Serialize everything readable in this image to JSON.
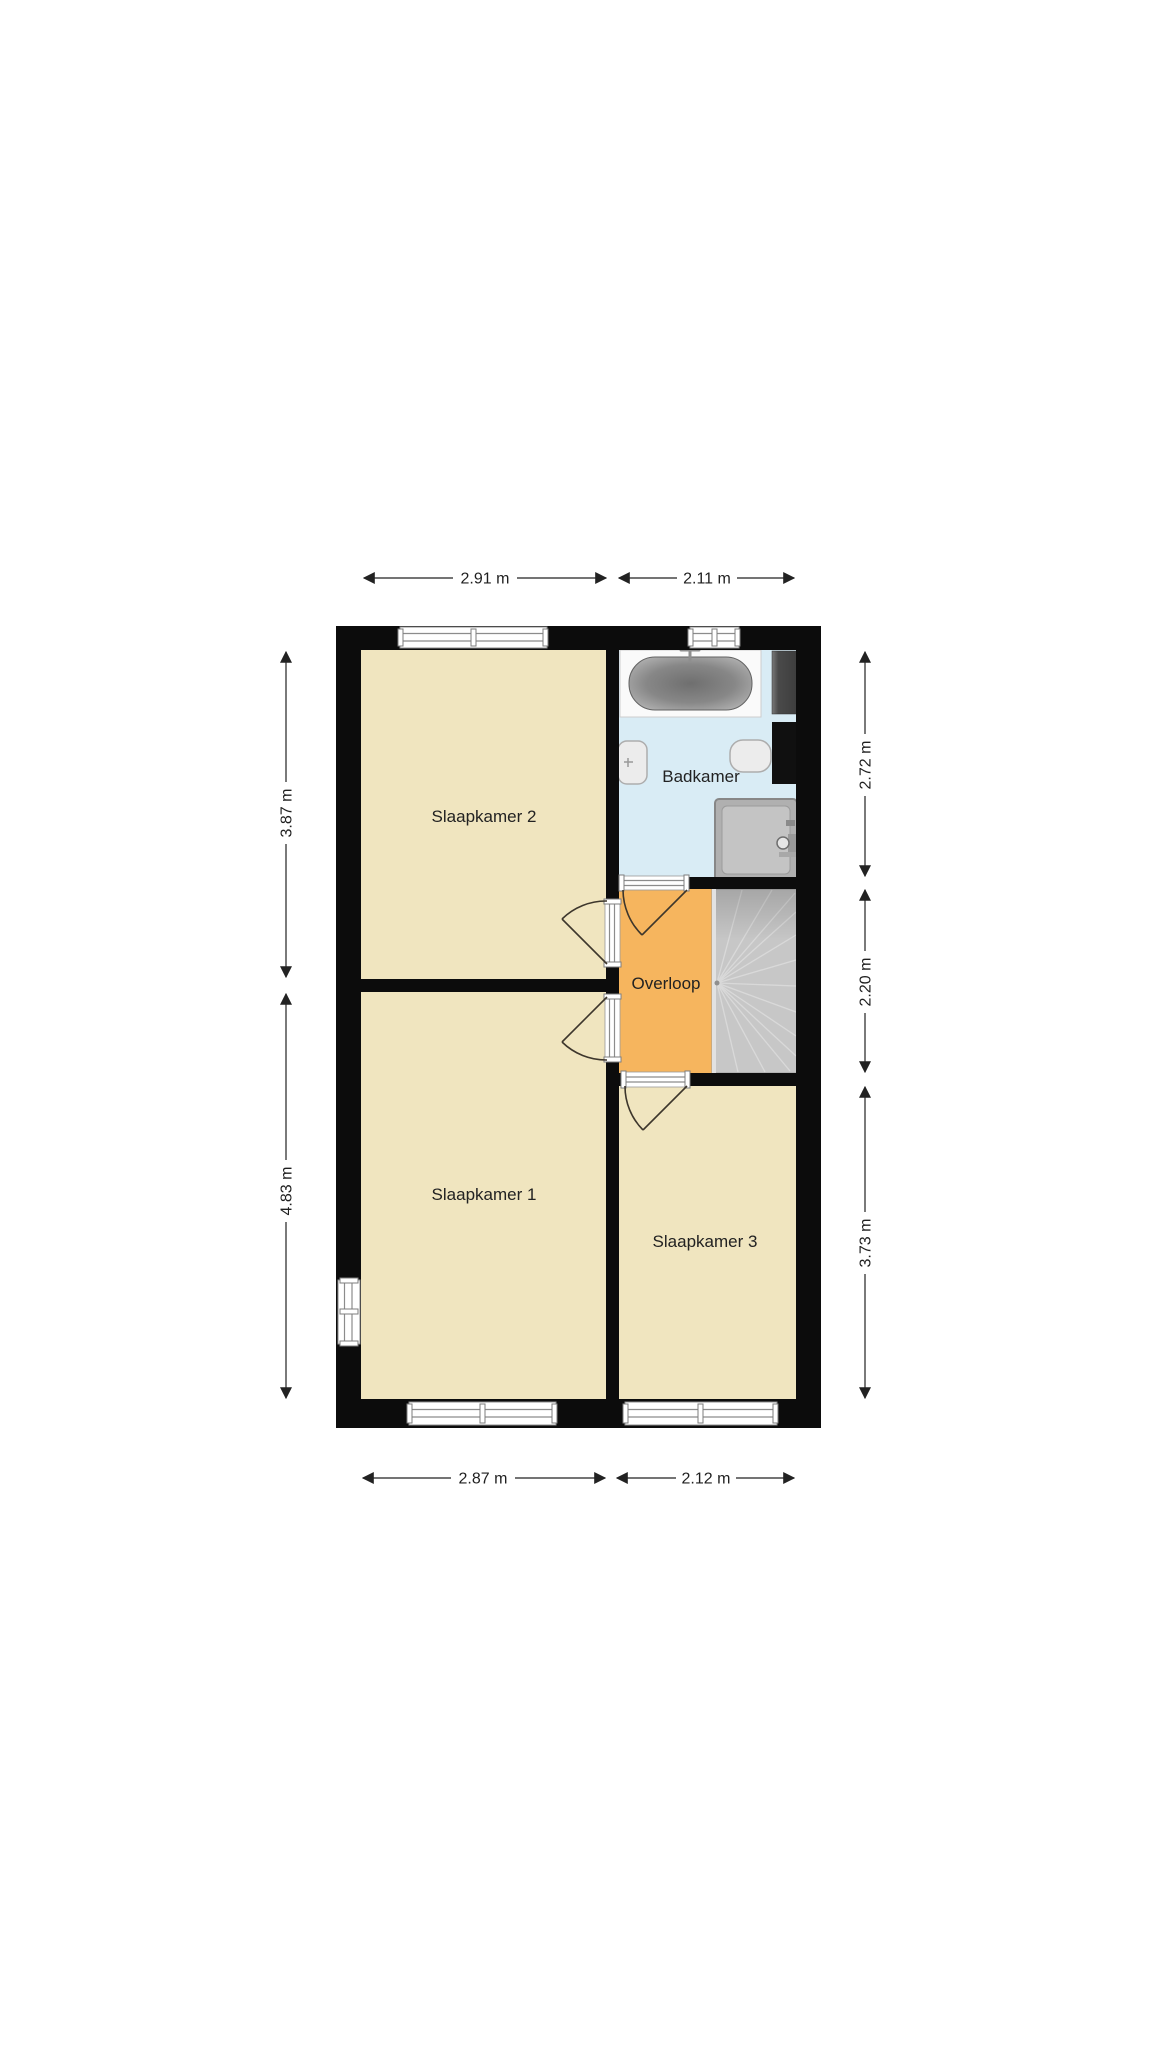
{
  "plan": {
    "type": "floorplan",
    "language": "nl",
    "rooms": [
      {
        "id": "slaapkamer-2",
        "label": "Slaapkamer 2",
        "color": "#f0e5bf"
      },
      {
        "id": "slaapkamer-1",
        "label": "Slaapkamer 1",
        "color": "#f0e5bf"
      },
      {
        "id": "slaapkamer-3",
        "label": "Slaapkamer 3",
        "color": "#f0e5bf"
      },
      {
        "id": "badkamer",
        "label": "Badkamer",
        "color": "#d9ecf5"
      },
      {
        "id": "overloop",
        "label": "Overloop",
        "color": "#f6b55e"
      }
    ],
    "fixtures": [
      "bathtub",
      "washbasin",
      "toilet",
      "shower",
      "staircase",
      "duct-shaft"
    ],
    "dimensions": {
      "top": [
        {
          "label": "2.91 m"
        },
        {
          "label": "2.11 m"
        }
      ],
      "bottom": [
        {
          "label": "2.87 m"
        },
        {
          "label": "2.12 m"
        }
      ],
      "left": [
        {
          "label": "3.87 m"
        },
        {
          "label": "4.83 m"
        }
      ],
      "right": [
        {
          "label": "2.72 m"
        },
        {
          "label": "2.20 m"
        },
        {
          "label": "3.73 m"
        }
      ]
    },
    "colors": {
      "wall": "#0c0c0c",
      "bedroom_fill": "#f0e5bf",
      "bathroom_fill": "#d9ecf5",
      "landing_fill": "#f6b55e",
      "stairs_fill": "#c7c7c7",
      "background": "#ffffff",
      "dimension_line": "#222222"
    }
  }
}
